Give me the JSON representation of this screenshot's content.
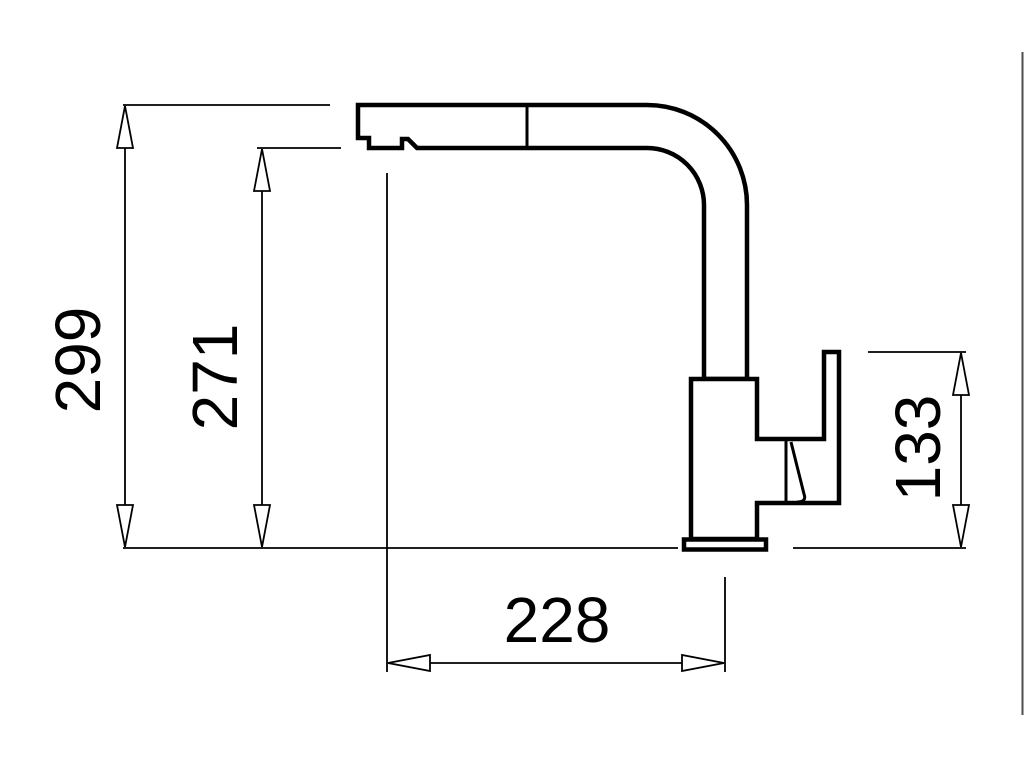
{
  "canvas": {
    "background_color": "#ffffff",
    "line_color": "#000000",
    "frame_edge_color": "#4d4d4d"
  },
  "dimensions": [
    {
      "id": "dim-299",
      "value": "299",
      "orientation": "vertical"
    },
    {
      "id": "dim-271",
      "value": "271",
      "orientation": "vertical"
    },
    {
      "id": "dim-133",
      "value": "133",
      "orientation": "vertical"
    },
    {
      "id": "dim-228",
      "value": "228",
      "orientation": "horizontal"
    }
  ]
}
